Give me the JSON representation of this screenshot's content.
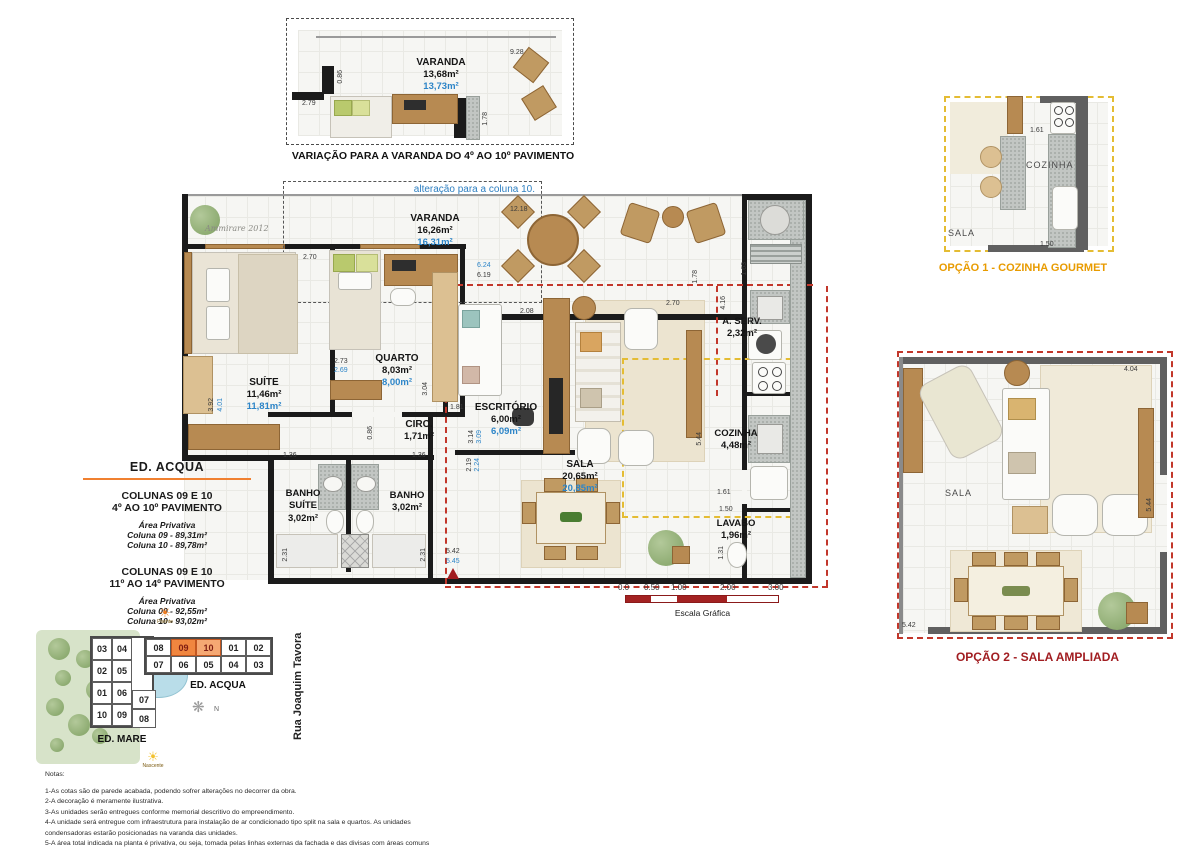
{
  "variant_plan": {
    "caption": "VARIAÇÃO PARA A VARANDA DO 4º AO 10º PAVIMENTO",
    "room_name": "VARANDA",
    "room_area": "13,68m²",
    "room_area_alt": "13,73m²",
    "dims": {
      "top": "9.28",
      "left_w": "0.86",
      "left": "2.79",
      "right": "1.78"
    }
  },
  "main_plan": {
    "alteration_note": "alteração para a coluna 10.",
    "signature": "Ammirare 2012",
    "rooms": {
      "varanda": {
        "name": "VARANDA",
        "area": "16,26m²",
        "area_alt": "16,31m²"
      },
      "suite": {
        "name": "SUÍTE",
        "area": "11,46m²",
        "area_alt": "11,81m²"
      },
      "quarto": {
        "name": "QUARTO",
        "area": "8,03m²",
        "area_alt": "8,00m²"
      },
      "circ": {
        "name": "CIRC.",
        "area": "1,71m²"
      },
      "escritorio": {
        "name": "ESCRITÓRIO",
        "area": "6,00m²",
        "area_alt": "6,09m²"
      },
      "sala": {
        "name": "SALA",
        "area": "20,65m²",
        "area_alt": "20,85m²"
      },
      "banho_suite": {
        "name": "BANHO SUÍTE",
        "area": "3,02m²"
      },
      "banho": {
        "name": "BANHO",
        "area": "3,02m²"
      },
      "aserv": {
        "name": "A. SERV.",
        "area": "2,32m²"
      },
      "cozinha": {
        "name": "COZINHA",
        "area": "4,48m²"
      },
      "lavabo": {
        "name": "LAVABO",
        "area": "1,96m²"
      }
    },
    "dims": {
      "d1218": "12.18",
      "d624": "6.24",
      "d619": "6.19",
      "d270a": "2.70",
      "d273": "2.73",
      "d269": "2.69",
      "d304": "3.04",
      "d392": "3.92",
      "d401": "4.01",
      "d086": "0.86",
      "d181": "1.81",
      "d208": "2.08",
      "d270b": "2.70",
      "d178": "1.78",
      "d163": "1.63",
      "d416": "4.16",
      "d314": "3.14",
      "d309": "3.09",
      "d219": "2.19",
      "d224": "2.24",
      "d136a": "1.36",
      "d136b": "1.36",
      "d231a": "2.31",
      "d231b": "2.31",
      "d542": "5.42",
      "d545": "5.45",
      "d544": "5.44",
      "d161": "1.61",
      "d150": "1.50",
      "d131": "1.31"
    }
  },
  "info_block": {
    "title": "ED. ACQUA",
    "sections": [
      {
        "line1": "COLUNAS 09 E 10",
        "line2": "4º AO 10º PAVIMENTO",
        "sub": "Área Privativa",
        "col09": "Coluna 09 - 89,31m²",
        "col10": "Coluna 10 - 89,78m²"
      },
      {
        "line1": "COLUNAS 09 E 10",
        "line2": "11º AO 14º PAVIMENTO",
        "sub": "Área Privativa",
        "col09": "Coluna 09 - 92,55m²",
        "col10": "Coluna 10 - 93,02m²"
      }
    ]
  },
  "scale_bar": {
    "labels": [
      "0.0",
      "0.50",
      "1.00",
      "2.00",
      "3.00"
    ],
    "title": "Escala Gráfica"
  },
  "site_plan": {
    "acqua": {
      "label": "ED. ACQUA",
      "top_row": [
        "08",
        "09",
        "10",
        "01",
        "02"
      ],
      "bottom_row": [
        "07",
        "06",
        "05",
        "04",
        "03"
      ]
    },
    "mare": {
      "label": "ED. MARE",
      "col1": [
        "03",
        "02",
        "01",
        "10"
      ],
      "col2": [
        "04",
        "05",
        "06",
        "09"
      ],
      "annex": [
        "07",
        "08"
      ]
    },
    "street": "Rua Joaquim Tavora",
    "compass": "N",
    "sun_top": "Poente",
    "sun_bottom": "Nascente"
  },
  "options": {
    "opt1": {
      "caption": "OPÇÃO 1 - COZINHA GOURMET",
      "labels": {
        "sala": "SALA",
        "cozinha": "COZINHA"
      },
      "dims": {
        "d161": "1.61",
        "d150": "1.50"
      }
    },
    "opt2": {
      "caption": "OPÇÃO 2 - SALA AMPLIADA",
      "labels": {
        "sala": "SALA"
      },
      "dims": {
        "d404": "4.04",
        "d544": "5.44",
        "d542": "5.42"
      }
    }
  },
  "notes": {
    "title": "Notas:",
    "lines": [
      "1-As cotas são de parede acabada, podendo sofrer alterações no decorrer da obra.",
      "2-A decoração é meramente ilustrativa.",
      "3-As unidades serão entregues conforme memorial descritivo do empreendimento.",
      "4-A unidade será entregue com infraestrutura para instalação de ar condicionado tipo split na sala e quartos. As unidades",
      "condensadoras estarão posicionadas na varanda das unidades.",
      "5-A área total indicada na planta é privativa, ou seja, tomada pelas linhas externas da fachada e das divisas com áreas comuns",
      "e pelo eixo das paredes divisórias entre apartamentos, conforme descrito na NBR 12.721 ABNT. Já as áreas indicadas nos",
      "compartimentos internos são úteis, desconsiderando paredes e outros elementos construtivos, conforme descrito na NBR 14.653-2 ABNT"
    ]
  }
}
